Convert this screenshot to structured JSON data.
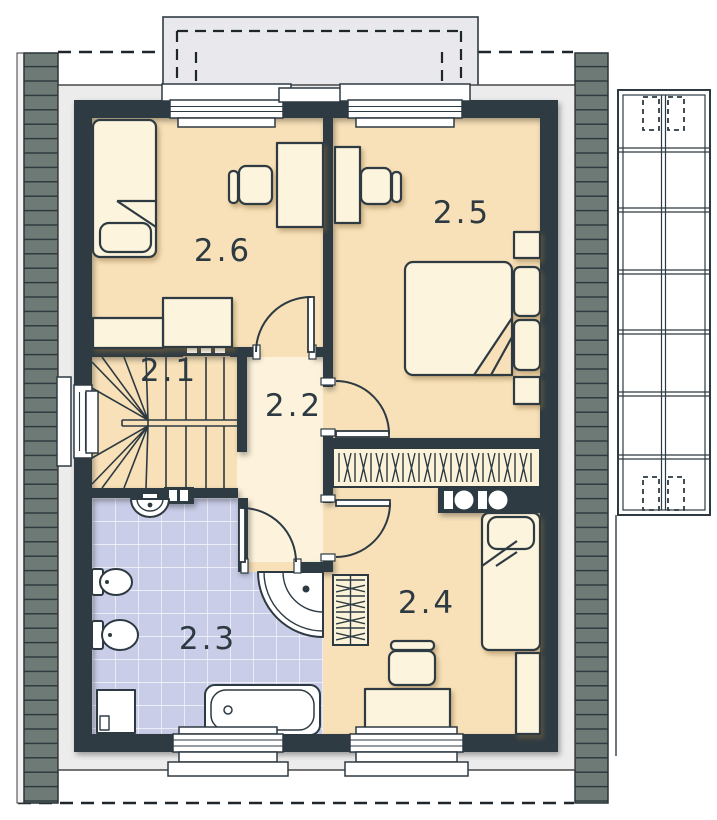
{
  "plan": {
    "rooms": [
      {
        "label": "2.1"
      },
      {
        "label": "2.2"
      },
      {
        "label": "2.3"
      },
      {
        "label": "2.4"
      },
      {
        "label": "2.5"
      },
      {
        "label": "2.6"
      }
    ],
    "colors": {
      "wall": "#2d3a42",
      "floor": "#f8e1b8",
      "hall_floor": "#fdf3dc",
      "bathroom_tile": "#c9cde8",
      "roof_strip": "#6e7a75",
      "dormer": "#e9e9ed",
      "furniture": "#fcf4dc",
      "line": "#2d3a42"
    }
  }
}
